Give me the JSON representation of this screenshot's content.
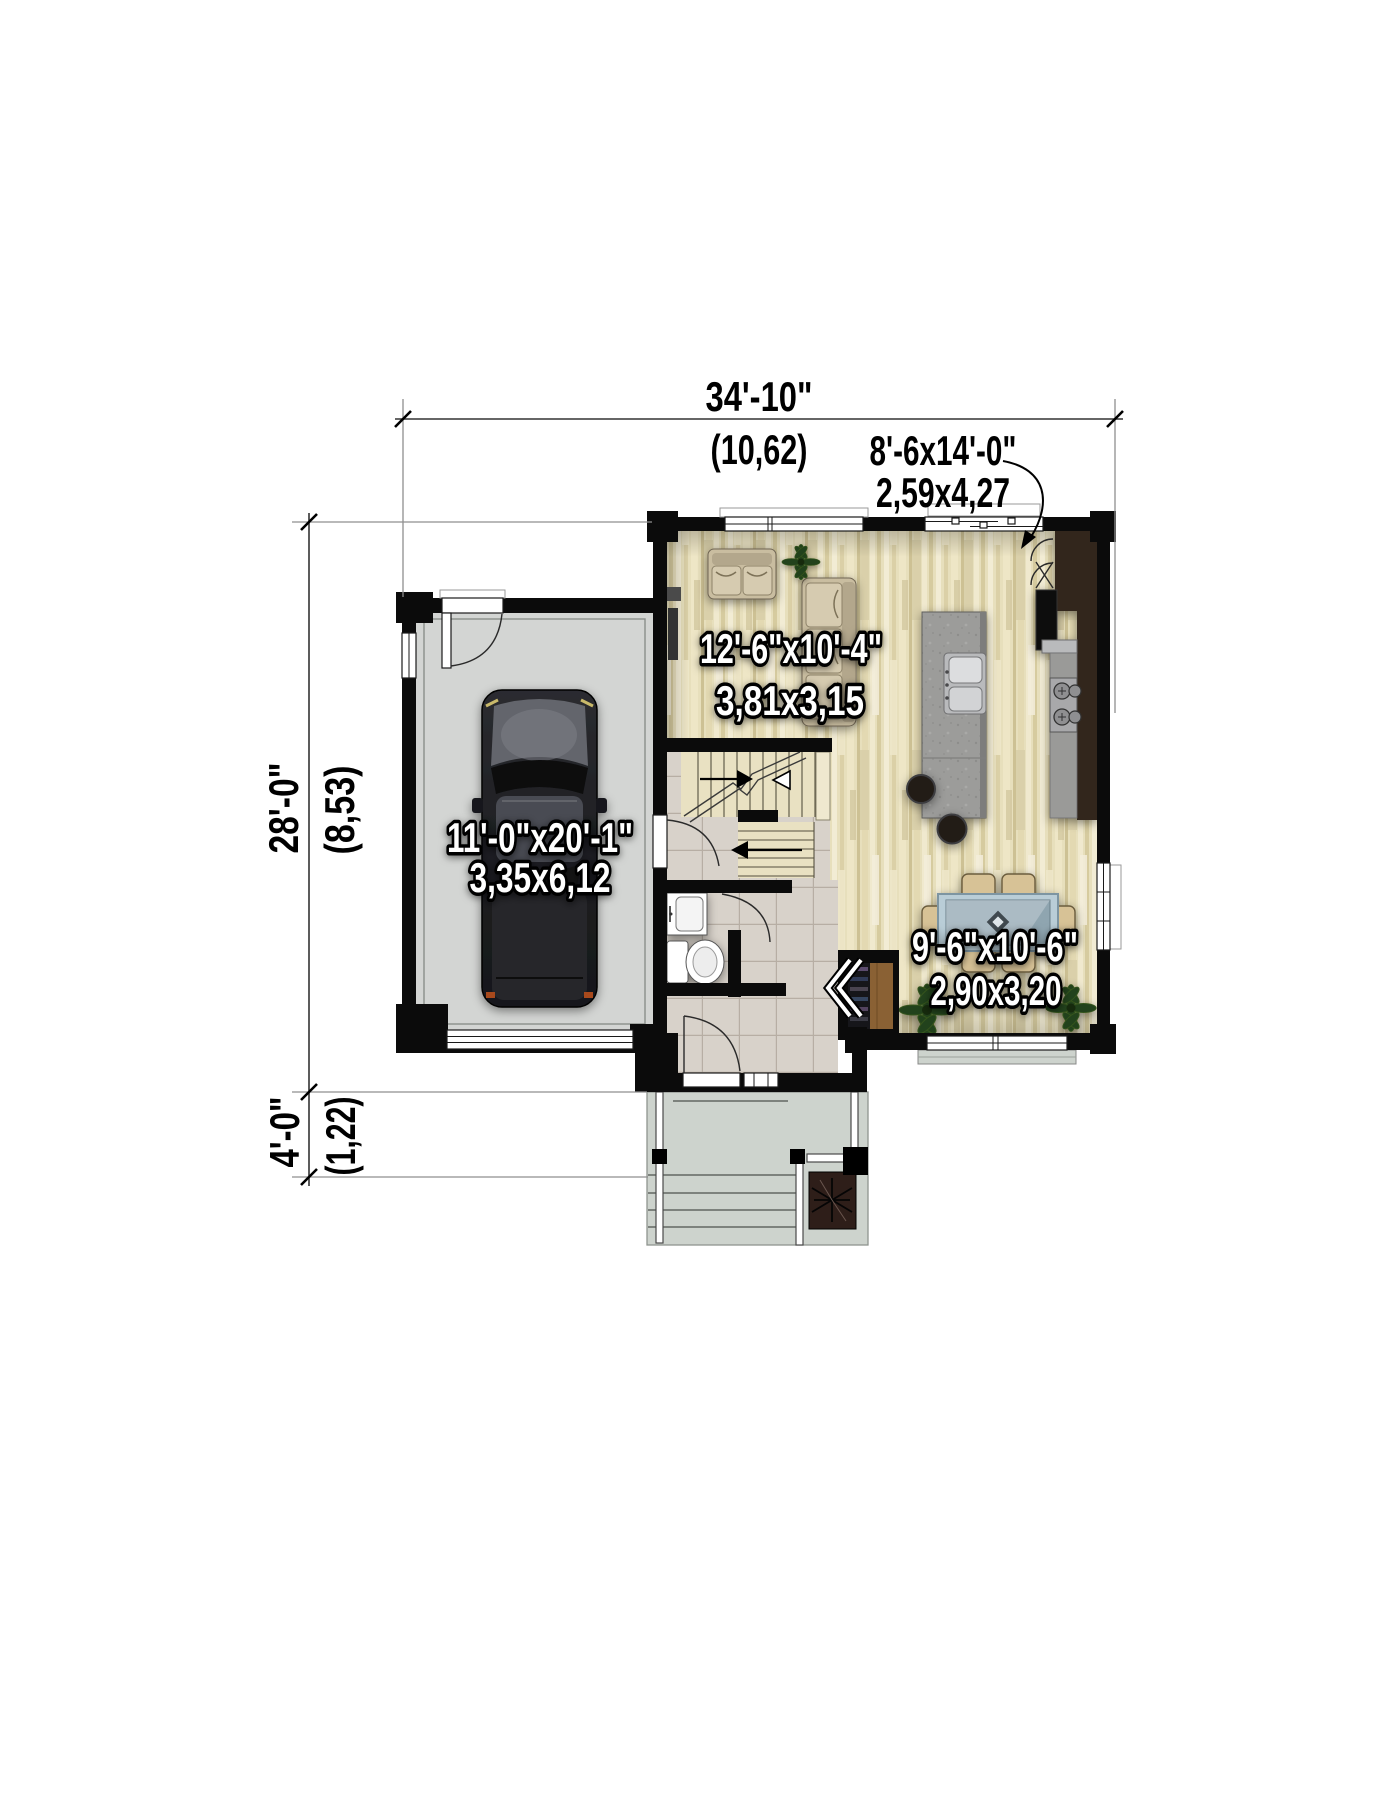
{
  "dimensions": {
    "overall_width_ft": "34'-10\"",
    "overall_width_m": "(10,62)",
    "patio_ft": "8'-6x14'-0\"",
    "patio_m": "2,59x4,27",
    "overall_depth_ft": "28'-0\"",
    "overall_depth_m": "(8,53)",
    "porch_depth_ft": "4'-0\"",
    "porch_depth_m": "(1,22)"
  },
  "rooms": {
    "living": {
      "size_ft": "12'-6\"x10'-4\"",
      "size_m": "3,81x3,15"
    },
    "garage": {
      "size_ft": "11'-0\"x20'-1\"",
      "size_m": "3,35x6,12"
    },
    "dining": {
      "size_ft": "9'-6\"x10'-6\"",
      "size_m": "2,90x3,20"
    }
  },
  "colors": {
    "wall": "#0b0b0b",
    "wood": "#e7dfbc",
    "tile": "#d8d2ca",
    "grout": "#b7aea4",
    "garage_floor": "#d3d5d3",
    "porch": "#cdd3cd",
    "island": "#9c9c9a",
    "counter": "#32271e",
    "closet_wood": "#8a6134",
    "table_glass": "#b9cdd7",
    "chair": "#d7c296",
    "plant": "#24421a",
    "dim_line": "#333333",
    "dim_text": "#000000",
    "label_fill": "#ffffff",
    "label_stroke": "#000000",
    "car_body": "#1d1e22"
  }
}
